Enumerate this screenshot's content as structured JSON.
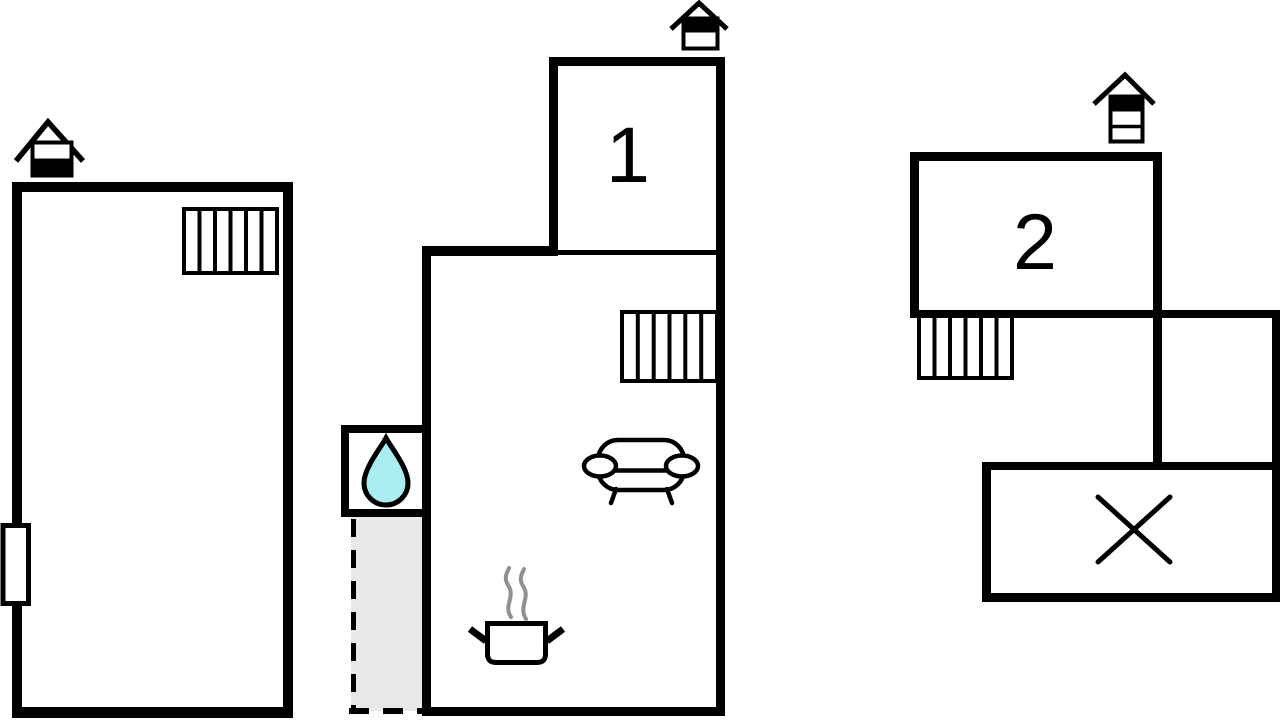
{
  "diagram": {
    "type": "floor-plan",
    "background": "#ffffff",
    "colors": {
      "wall": "#000000",
      "water_drop_fill": "#abeef2",
      "annex_fill": "#e8e8e8",
      "steam": "#909090"
    },
    "rooms": [
      {
        "id": "bedroom-1",
        "label": "1"
      },
      {
        "id": "bedroom-2",
        "label": "2"
      }
    ],
    "buildings": [
      {
        "id": "building-left",
        "features": [
          "chimney",
          "radiator",
          "window-marker"
        ]
      },
      {
        "id": "building-main",
        "features": [
          "chimney",
          "room-1",
          "radiator",
          "sofa",
          "cooking-pot",
          "steam",
          "water-closet",
          "dashed-annex-area"
        ]
      },
      {
        "id": "building-right",
        "features": [
          "chimney",
          "room-2",
          "radiator",
          "cross-marked-room"
        ]
      }
    ],
    "icons": [
      {
        "name": "chimney-icon",
        "count": 3
      },
      {
        "name": "radiator-icon",
        "count": 3
      },
      {
        "name": "water-drop-icon",
        "count": 1
      },
      {
        "name": "sofa-icon",
        "count": 1
      },
      {
        "name": "cooking-pot-icon",
        "count": 1
      },
      {
        "name": "steam-icon",
        "count": 1
      },
      {
        "name": "window-marker",
        "count": 1
      },
      {
        "name": "cross-mark",
        "count": 1
      },
      {
        "name": "dashed-annex-area",
        "count": 1
      }
    ]
  }
}
